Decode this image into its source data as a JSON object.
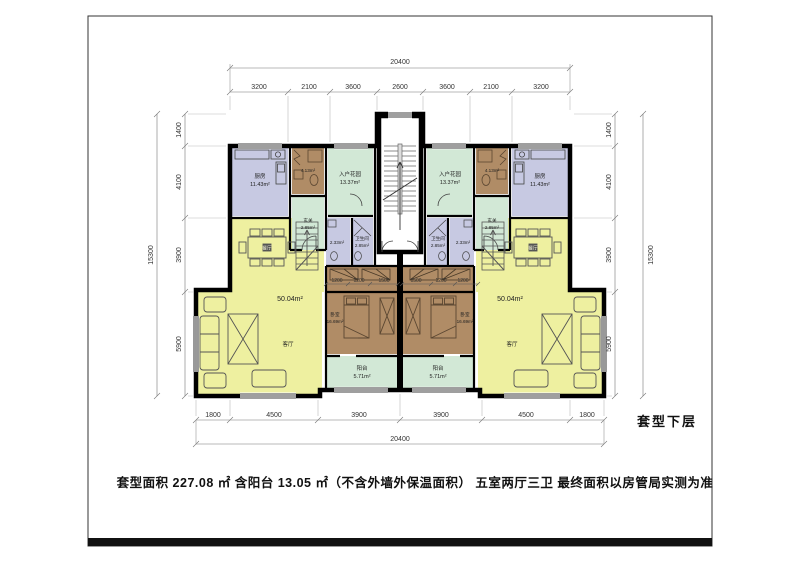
{
  "sheet": {
    "caption": "套型面积 227.08 ㎡ 含阳台 13.05 ㎡（不含外墙外保温面积） 五室两厅三卫 最终面积以房管局实测为准",
    "floor_label": "套型下层"
  },
  "dimensions": {
    "top_total": "20400",
    "top_segments": [
      "3200",
      "2100",
      "3600",
      "2600",
      "3600",
      "2100",
      "3200"
    ],
    "bottom_segments": [
      "1800",
      "4500",
      "3900",
      "3900",
      "4500",
      "1800"
    ],
    "bottom_total": "20400",
    "side_total": "15300",
    "side_segments": [
      "1400",
      "4100",
      "3900",
      "5900"
    ],
    "interior_left": [
      "1200",
      "1200",
      "1500"
    ],
    "interior_right": [
      "1500",
      "1200",
      "1200"
    ]
  },
  "rooms": {
    "kitchen": {
      "name": "厨房",
      "area": "11.43m²"
    },
    "bath_upper": {
      "area": "4.13m²"
    },
    "entry_garden": {
      "name": "入户花园",
      "area": "13.37m²"
    },
    "foyer": {
      "name": "玄关",
      "area": "2.85m²"
    },
    "wc_small": {
      "area": "2.33m²"
    },
    "wc": {
      "name": "卫生间",
      "area": "2.85m²"
    },
    "living_dining": {
      "area": "50.04m²"
    },
    "living": {
      "name": "客厅"
    },
    "dining": {
      "name": "餐厅"
    },
    "bedroom": {
      "name": "卧室",
      "area": "16.69m²"
    },
    "balcony": {
      "name": "阳台",
      "area": "5.71m²"
    }
  },
  "colors": {
    "wall": "#000000",
    "room_yellow": "#eef0a0",
    "room_purple": "#c7c9e2",
    "room_brown": "#b08c66",
    "room_green": "#d2e8d6",
    "dim_line": "#555555"
  }
}
